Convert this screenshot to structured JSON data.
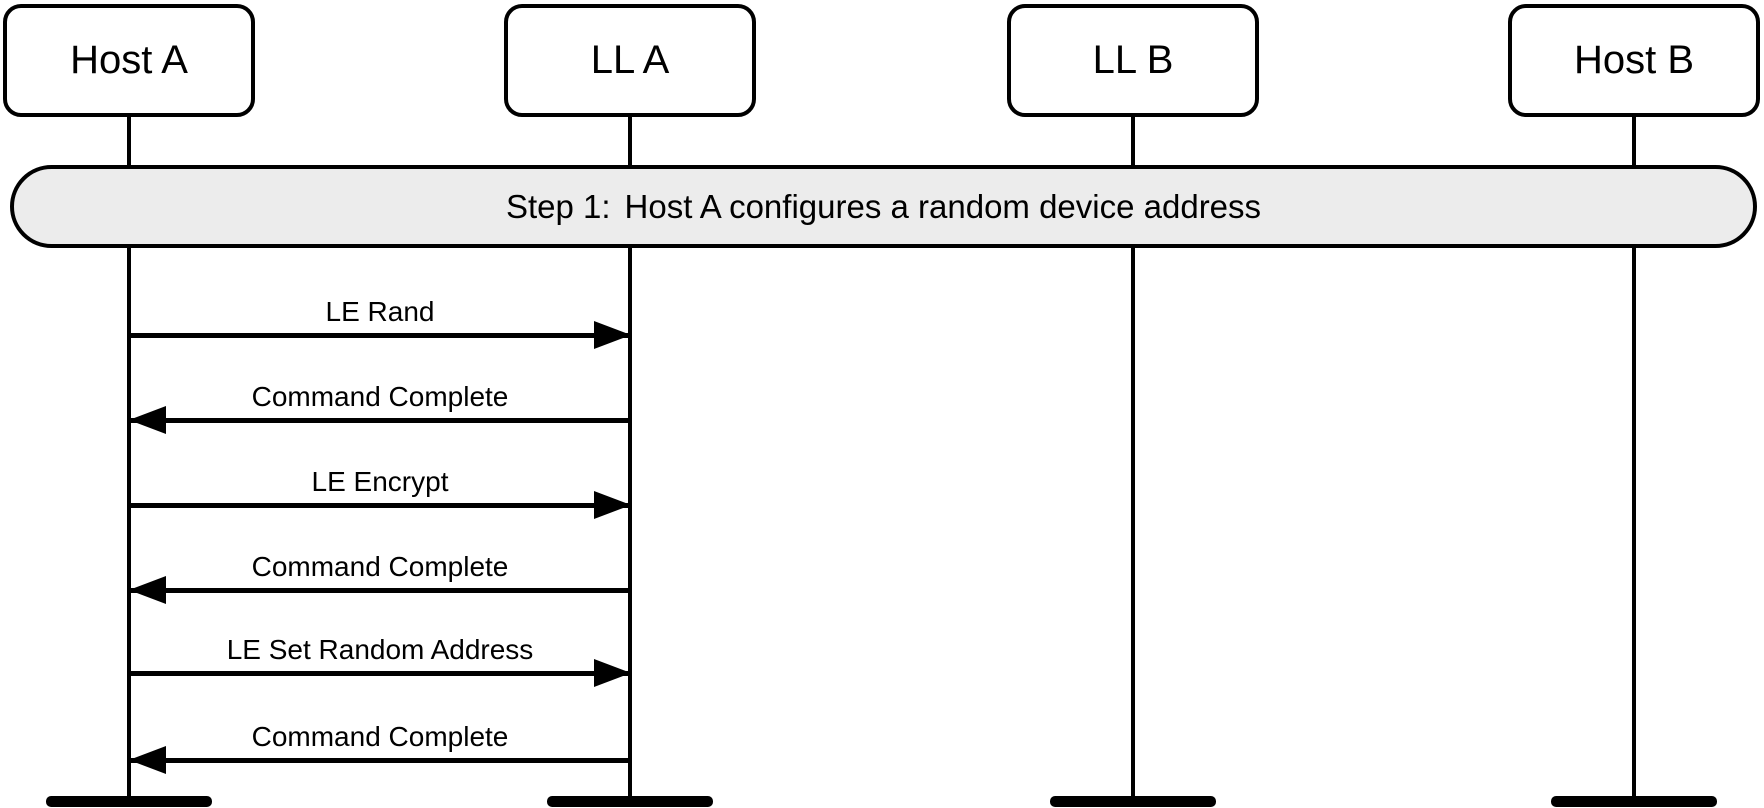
{
  "diagram": {
    "kind": "message-sequence-chart",
    "participants": [
      {
        "id": "host-a",
        "label": "Host A"
      },
      {
        "id": "ll-a",
        "label": "LL A"
      },
      {
        "id": "ll-b",
        "label": "LL B"
      },
      {
        "id": "host-b",
        "label": "Host B"
      }
    ],
    "step_banner": {
      "prefix": "Step 1:",
      "text": "Host A configures a random device address"
    },
    "messages": [
      {
        "label": "LE Rand",
        "from": "Host A",
        "to": "LL A",
        "direction": "right"
      },
      {
        "label": "Command Complete",
        "from": "LL A",
        "to": "Host A",
        "direction": "left"
      },
      {
        "label": "LE Encrypt",
        "from": "Host A",
        "to": "LL A",
        "direction": "right"
      },
      {
        "label": "Command Complete",
        "from": "LL A",
        "to": "Host A",
        "direction": "left"
      },
      {
        "label": "LE Set Random Address",
        "from": "Host A",
        "to": "LL A",
        "direction": "right"
      },
      {
        "label": "Command Complete",
        "from": "LL A",
        "to": "Host A",
        "direction": "left"
      }
    ],
    "colors": {
      "line": "#000000",
      "background": "#ffffff",
      "banner_fill": "#ececec",
      "box_fill": "#ffffff"
    }
  }
}
